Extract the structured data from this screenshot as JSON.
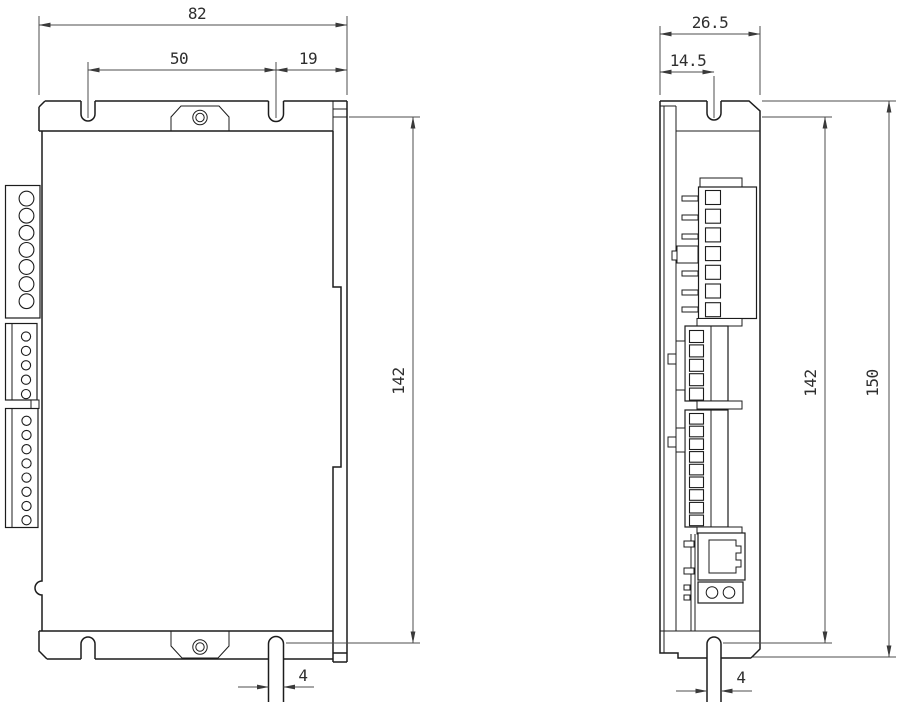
{
  "drawing": {
    "type": "engineering-dimension-drawing",
    "unit": "mm",
    "colors": {
      "outline": "#1c1c1c",
      "dimension": "#4d4d4d",
      "background": "#ffffff"
    }
  },
  "front_view": {
    "dimensions": {
      "overall_width": "82",
      "slot_spacing": "50",
      "slot_to_edge": "19",
      "mounting_height": "142",
      "slot_width": "4"
    },
    "terminal_blocks": [
      {
        "name": "power-terminal",
        "positions": 7
      },
      {
        "name": "signal-terminal-upper",
        "positions": 5
      },
      {
        "name": "signal-terminal-lower",
        "positions": 8
      }
    ]
  },
  "side_view": {
    "dimensions": {
      "overall_depth": "26.5",
      "slot_center_offset": "14.5",
      "mounting_height": "142",
      "overall_height": "150",
      "slot_width": "4"
    },
    "terminal_blocks": [
      {
        "name": "power-terminal-side",
        "positions": 7
      },
      {
        "name": "signal-terminal-upper-side",
        "positions": 5
      },
      {
        "name": "signal-terminal-lower-side",
        "positions": 9
      }
    ]
  }
}
